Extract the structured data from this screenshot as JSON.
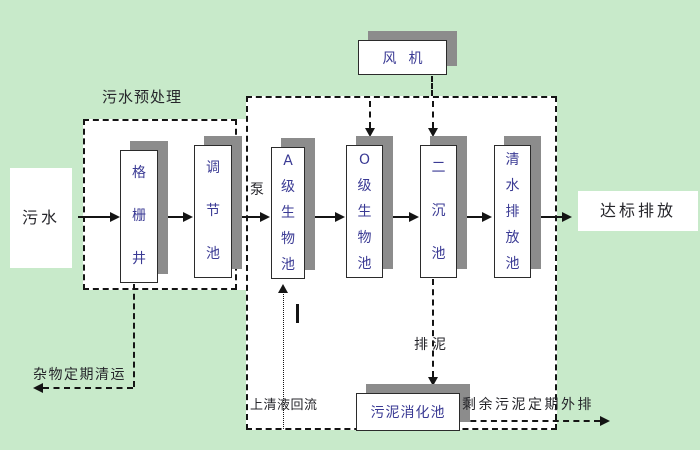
{
  "colors": {
    "bg_green": "#c8eaca",
    "box_fill": "#ffffff",
    "box_border": "#2b2b2b",
    "box_text": "#3a3a94",
    "shadow": "#8c8c8c",
    "line": "#141414",
    "label_text": "#26262b"
  },
  "nodes": {
    "grille_well": "格栅井",
    "regulating_tank": "调节池",
    "a_bio_tank": "A级生物池",
    "o_bio_tank": "O级生物池",
    "secondary_sed_tank": "二沉池",
    "clear_water_tank": "清水排放池",
    "blower": "风机",
    "sludge_digestion_tank": "污泥消化池"
  },
  "labels": {
    "influent": "污水",
    "effluent": "达标排放",
    "pretreatment_group": "污水预处理",
    "pump": "泵",
    "debris_removal": "杂物定期清运",
    "supernatant_return": "上清液回流",
    "sludge_discharge": "排泥",
    "excess_sludge_out": "剩余污泥定期外排"
  }
}
